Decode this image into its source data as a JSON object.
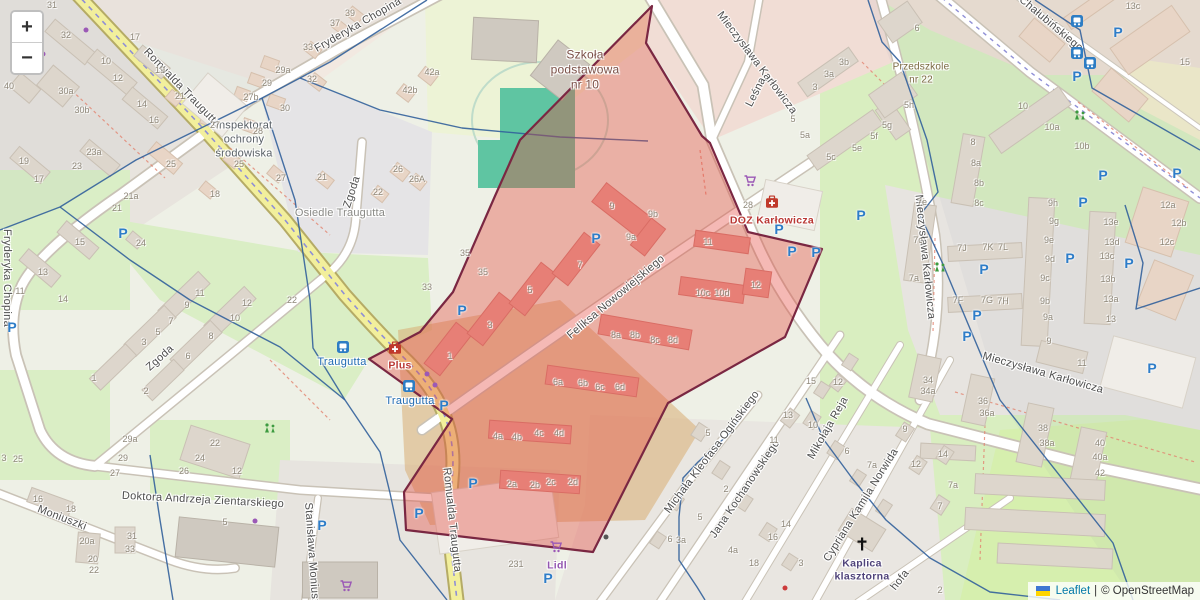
{
  "zoom_control": {
    "zoom_in": "+",
    "zoom_out": "−"
  },
  "attribution": {
    "flag": "ukraine-flag",
    "leaflet_link": "Leaflet",
    "separator": "|",
    "osm_text": "© OpenStreetMap"
  },
  "colors": {
    "map_background": "#eef0e6",
    "highlight_fill": "rgba(229,72,60,0.38)",
    "highlight_border": "#7a2742",
    "boundary_blue": "#32609b",
    "parking_blue": "#2e7dc8",
    "transit_blue": "#1f6ab3",
    "shop_purple": "#9b59b6",
    "pharmacy_red": "#c0392b",
    "school_label_brown": "#7b5047",
    "church_label_purple": "#4f437a",
    "lidl_purple": "#9355b0",
    "doz_red": "#b93632",
    "road_yellow": "#f2ef9c"
  },
  "highlight_zone": {
    "points": "652,6 646,43 702,136 710,143 748,232 822,249 785,337 668,403 593,552 406,530 404,492 452,419 369,359 420,332 453,292 495,196 520,140",
    "fill": "rgba(229,72,60,0.38)",
    "border": "#7a2742"
  },
  "map": {
    "street_labels": [
      {
        "t": "Romualda Traugutta",
        "x": 182,
        "y": 88,
        "r": 46
      },
      {
        "t": "Romualda Traugutta",
        "x": 452,
        "y": 520,
        "r": 84
      },
      {
        "t": "Fryderyka Chopina",
        "x": 358,
        "y": 25,
        "r": -30
      },
      {
        "t": "Fryderyka Chopina",
        "x": 7,
        "y": 278,
        "r": 90
      },
      {
        "t": "Stanisława Moniuszki",
        "x": 312,
        "y": 558,
        "r": 86
      },
      {
        "t": "Moniuszki",
        "x": 62,
        "y": 518,
        "r": 21
      },
      {
        "t": "Zgoda",
        "x": 160,
        "y": 358,
        "r": -42
      },
      {
        "t": "Zgoda",
        "x": 352,
        "y": 192,
        "r": -72
      },
      {
        "t": "Doktora Andrzeja Zientarskiego",
        "x": 203,
        "y": 500,
        "r": 3
      },
      {
        "t": "Mieczysława Karłowicza",
        "x": 757,
        "y": 63,
        "r": 53
      },
      {
        "t": "Mieczysława Karłowicza",
        "x": 925,
        "y": 257,
        "r": 84
      },
      {
        "t": "Mieczysława Karłowicza",
        "x": 1043,
        "y": 373,
        "r": 16
      },
      {
        "t": "Leśna",
        "x": 756,
        "y": 92,
        "r": -63
      },
      {
        "t": "Chałubińskiego",
        "x": 1051,
        "y": 24,
        "r": 40
      },
      {
        "t": "Feliksa Nowowiejskiego",
        "x": 616,
        "y": 297,
        "r": -40
      },
      {
        "t": "Jana Kochanowskiego",
        "x": 745,
        "y": 489,
        "r": -56
      },
      {
        "t": "Michała Kleofasa Ogińskiego",
        "x": 712,
        "y": 452,
        "r": -53
      },
      {
        "t": "Mikołaja Reja",
        "x": 828,
        "y": 428,
        "r": -60
      },
      {
        "t": "Cypriana Kamila Norwida",
        "x": 861,
        "y": 505,
        "r": -58
      },
      {
        "t": "hofa",
        "x": 900,
        "y": 580,
        "r": -52
      }
    ],
    "area_labels": [
      {
        "t": "Osiedle Traugutta",
        "x": 340,
        "y": 214,
        "c": "#8a8a86",
        "s": 11
      },
      {
        "t": "Inspektorat\nochrony\nśrodowiska",
        "x": 244,
        "y": 140,
        "c": "#596066",
        "s": 11
      },
      {
        "t": "Szkoła\npodstawowa\nnr 10",
        "x": 585,
        "y": 70,
        "c": "#7b5047",
        "s": 12
      },
      {
        "t": "Przedszkole\nnr 22",
        "x": 921,
        "y": 74,
        "c": "#7a6840",
        "s": 10
      }
    ],
    "poi_labels": [
      {
        "t": "DOZ Karłowicza",
        "x": 772,
        "y": 221,
        "c": "#b93632"
      },
      {
        "t": "Plus",
        "x": 400,
        "y": 366,
        "c": "#b93632"
      },
      {
        "t": "Lidl",
        "x": 557,
        "y": 566,
        "c": "#9355b0"
      },
      {
        "t": "Kaplica\nklasztorna",
        "x": 862,
        "y": 570,
        "c": "#4f437a"
      }
    ],
    "transit_stops": [
      {
        "t": "Traugutta",
        "ix": 343,
        "iy": 347,
        "x": 342,
        "y": 362
      },
      {
        "t": "Traugutta",
        "ix": 409,
        "iy": 386,
        "x": 410,
        "y": 401
      }
    ],
    "house_numbers": [
      [
        52,
        5,
        "31"
      ],
      [
        135,
        37,
        "17"
      ],
      [
        66,
        35,
        "32"
      ],
      [
        106,
        61,
        "10"
      ],
      [
        118,
        78,
        "12"
      ],
      [
        142,
        104,
        "14"
      ],
      [
        154,
        120,
        "16"
      ],
      [
        66,
        91,
        "30a"
      ],
      [
        82,
        110,
        "30b"
      ],
      [
        9,
        86,
        "40"
      ],
      [
        160,
        70,
        "19"
      ],
      [
        180,
        96,
        "21"
      ],
      [
        283,
        70,
        "29a"
      ],
      [
        267,
        83,
        "29"
      ],
      [
        251,
        97,
        "27b"
      ],
      [
        285,
        108,
        "30"
      ],
      [
        258,
        131,
        "28"
      ],
      [
        215,
        125,
        "27"
      ],
      [
        171,
        164,
        "25"
      ],
      [
        239,
        164,
        "25"
      ],
      [
        281,
        178,
        "27"
      ],
      [
        94,
        152,
        "23a"
      ],
      [
        77,
        166,
        "23"
      ],
      [
        24,
        161,
        "19"
      ],
      [
        39,
        179,
        "17"
      ],
      [
        215,
        194,
        "18"
      ],
      [
        131,
        196,
        "21a"
      ],
      [
        117,
        208,
        "21"
      ],
      [
        80,
        242,
        "15"
      ],
      [
        43,
        272,
        "13"
      ],
      [
        20,
        291,
        "11"
      ],
      [
        141,
        243,
        "24"
      ],
      [
        350,
        13,
        "39"
      ],
      [
        335,
        23,
        "37"
      ],
      [
        308,
        47,
        "33"
      ],
      [
        312,
        79,
        "32"
      ],
      [
        432,
        72,
        "42a"
      ],
      [
        410,
        90,
        "42b"
      ],
      [
        322,
        177,
        "21"
      ],
      [
        398,
        169,
        "26"
      ],
      [
        417,
        179,
        "26A"
      ],
      [
        378,
        192,
        "22"
      ],
      [
        63,
        299,
        "14"
      ],
      [
        94,
        378,
        "1"
      ],
      [
        144,
        342,
        "3"
      ],
      [
        158,
        332,
        "5"
      ],
      [
        171,
        321,
        "7"
      ],
      [
        187,
        305,
        "9"
      ],
      [
        200,
        293,
        "11"
      ],
      [
        146,
        391,
        "2"
      ],
      [
        188,
        356,
        "6"
      ],
      [
        211,
        336,
        "8"
      ],
      [
        235,
        318,
        "10"
      ],
      [
        247,
        303,
        "12"
      ],
      [
        292,
        300,
        "22"
      ],
      [
        130,
        439,
        "29a"
      ],
      [
        123,
        458,
        "29"
      ],
      [
        115,
        473,
        "27"
      ],
      [
        215,
        443,
        "22"
      ],
      [
        200,
        458,
        "24"
      ],
      [
        184,
        471,
        "26"
      ],
      [
        237,
        471,
        "12"
      ],
      [
        4,
        458,
        "3"
      ],
      [
        18,
        459,
        "25"
      ],
      [
        38,
        499,
        "16"
      ],
      [
        71,
        509,
        "18"
      ],
      [
        87,
        541,
        "20a"
      ],
      [
        93,
        559,
        "20"
      ],
      [
        94,
        570,
        "22"
      ],
      [
        132,
        536,
        "31"
      ],
      [
        130,
        549,
        "33"
      ],
      [
        225,
        522,
        "5"
      ],
      [
        516,
        564,
        "231"
      ],
      [
        612,
        206,
        "9"
      ],
      [
        653,
        214,
        "9b"
      ],
      [
        631,
        237,
        "9a"
      ],
      [
        580,
        265,
        "7"
      ],
      [
        530,
        290,
        "5"
      ],
      [
        490,
        325,
        "3"
      ],
      [
        450,
        356,
        "1"
      ],
      [
        616,
        335,
        "8a"
      ],
      [
        635,
        335,
        "8b"
      ],
      [
        655,
        340,
        "8c"
      ],
      [
        673,
        340,
        "8d"
      ],
      [
        558,
        382,
        "6a"
      ],
      [
        583,
        383,
        "6b"
      ],
      [
        600,
        387,
        "6c"
      ],
      [
        620,
        387,
        "6d"
      ],
      [
        703,
        293,
        "10c"
      ],
      [
        722,
        293,
        "10d"
      ],
      [
        708,
        242,
        "11"
      ],
      [
        756,
        285,
        "12"
      ],
      [
        498,
        436,
        "4a"
      ],
      [
        517,
        437,
        "4b"
      ],
      [
        539,
        433,
        "4c"
      ],
      [
        559,
        433,
        "4d"
      ],
      [
        512,
        484,
        "2a"
      ],
      [
        535,
        485,
        "2b"
      ],
      [
        551,
        482,
        "2c"
      ],
      [
        573,
        482,
        "2d"
      ],
      [
        748,
        205,
        "28"
      ],
      [
        465,
        253,
        "35"
      ],
      [
        483,
        272,
        "35"
      ],
      [
        427,
        287,
        "33"
      ],
      [
        844,
        62,
        "3b"
      ],
      [
        829,
        74,
        "3a"
      ],
      [
        815,
        87,
        "3"
      ],
      [
        793,
        119,
        "5"
      ],
      [
        805,
        135,
        "5a"
      ],
      [
        831,
        157,
        "5c"
      ],
      [
        857,
        148,
        "5e"
      ],
      [
        874,
        136,
        "5f"
      ],
      [
        887,
        125,
        "5g"
      ],
      [
        909,
        105,
        "5h"
      ],
      [
        917,
        28,
        "6"
      ],
      [
        1185,
        62,
        "15"
      ],
      [
        1133,
        6,
        "13c"
      ],
      [
        1023,
        106,
        "10"
      ],
      [
        1052,
        127,
        "10a"
      ],
      [
        1082,
        146,
        "10b"
      ],
      [
        973,
        142,
        "8"
      ],
      [
        976,
        163,
        "8a"
      ],
      [
        979,
        183,
        "8b"
      ],
      [
        979,
        203,
        "8c"
      ],
      [
        922,
        202,
        "7e"
      ],
      [
        918,
        240,
        "7c"
      ],
      [
        914,
        278,
        "7a"
      ],
      [
        962,
        248,
        "7J"
      ],
      [
        988,
        247,
        "7K"
      ],
      [
        1003,
        247,
        "7L"
      ],
      [
        958,
        300,
        "7F"
      ],
      [
        987,
        300,
        "7G"
      ],
      [
        1003,
        301,
        "7H"
      ],
      [
        1053,
        203,
        "9h"
      ],
      [
        1054,
        221,
        "9g"
      ],
      [
        1049,
        240,
        "9e"
      ],
      [
        1050,
        259,
        "9d"
      ],
      [
        1045,
        278,
        "9c"
      ],
      [
        1045,
        301,
        "9b"
      ],
      [
        1048,
        317,
        "9a"
      ],
      [
        1049,
        341,
        "9"
      ],
      [
        1111,
        222,
        "13e"
      ],
      [
        1112,
        242,
        "13d"
      ],
      [
        1107,
        256,
        "13c"
      ],
      [
        1108,
        279,
        "13b"
      ],
      [
        1111,
        299,
        "13a"
      ],
      [
        1111,
        319,
        "13"
      ],
      [
        1168,
        205,
        "12a"
      ],
      [
        1179,
        223,
        "12b"
      ],
      [
        1167,
        242,
        "12c"
      ],
      [
        1082,
        363,
        "11"
      ],
      [
        928,
        380,
        "34"
      ],
      [
        928,
        391,
        "34a"
      ],
      [
        983,
        401,
        "36"
      ],
      [
        987,
        413,
        "36a"
      ],
      [
        811,
        381,
        "15"
      ],
      [
        838,
        382,
        "12"
      ],
      [
        788,
        415,
        "13"
      ],
      [
        813,
        425,
        "10"
      ],
      [
        774,
        440,
        "11"
      ],
      [
        847,
        451,
        "6"
      ],
      [
        872,
        465,
        "7a"
      ],
      [
        905,
        429,
        "9"
      ],
      [
        916,
        464,
        "12"
      ],
      [
        943,
        454,
        "14"
      ],
      [
        1043,
        428,
        "38"
      ],
      [
        1047,
        443,
        "38a"
      ],
      [
        1100,
        443,
        "40"
      ],
      [
        1100,
        457,
        "40a"
      ],
      [
        1100,
        473,
        "42"
      ],
      [
        953,
        485,
        "7a"
      ],
      [
        940,
        506,
        "7"
      ],
      [
        940,
        590,
        "2"
      ],
      [
        726,
        489,
        "2"
      ],
      [
        708,
        433,
        "5"
      ],
      [
        700,
        517,
        "5"
      ],
      [
        670,
        539,
        "6"
      ],
      [
        681,
        540,
        "3a"
      ],
      [
        733,
        550,
        "4a"
      ],
      [
        754,
        563,
        "18"
      ],
      [
        801,
        563,
        "3"
      ],
      [
        786,
        524,
        "14"
      ],
      [
        773,
        537,
        "16"
      ]
    ],
    "icons": {
      "parking_glyph": "P",
      "parking": [
        [
          12,
          327
        ],
        [
          123,
          233
        ],
        [
          596,
          238
        ],
        [
          462,
          310
        ],
        [
          444,
          405
        ],
        [
          419,
          513
        ],
        [
          473,
          483
        ],
        [
          548,
          578
        ],
        [
          322,
          525
        ],
        [
          779,
          229
        ],
        [
          792,
          251
        ],
        [
          816,
          252
        ],
        [
          861,
          215
        ],
        [
          984,
          269
        ],
        [
          977,
          315
        ],
        [
          967,
          336
        ],
        [
          1083,
          202
        ],
        [
          1070,
          258
        ],
        [
          1129,
          263
        ],
        [
          1152,
          368
        ],
        [
          1118,
          32
        ],
        [
          1077,
          76
        ],
        [
          1177,
          173
        ],
        [
          1103,
          175
        ]
      ],
      "bus_stops": [
        [
          1077,
          21
        ],
        [
          1077,
          53
        ],
        [
          1090,
          63
        ]
      ],
      "shop_carts": [
        [
          750,
          181
        ],
        [
          556,
          547
        ],
        [
          346,
          586
        ]
      ],
      "pharmacies": [
        [
          772,
          202
        ],
        [
          395,
          348
        ]
      ],
      "playgrounds": [
        [
          270,
          428
        ],
        [
          940,
          267
        ],
        [
          1080,
          115
        ]
      ],
      "church_crosses": [
        [
          862,
          544
        ]
      ],
      "small_dots": [
        [
          86,
          30,
          "#9b59b6"
        ],
        [
          43,
          54,
          "#9b59b6"
        ],
        [
          255,
          521,
          "#9b59b6"
        ],
        [
          606,
          537,
          "#555555"
        ],
        [
          785,
          588,
          "#cc3b3b"
        ],
        [
          427,
          374,
          "#9b59b6"
        ],
        [
          435,
          385,
          "#9b59b6"
        ]
      ]
    }
  }
}
